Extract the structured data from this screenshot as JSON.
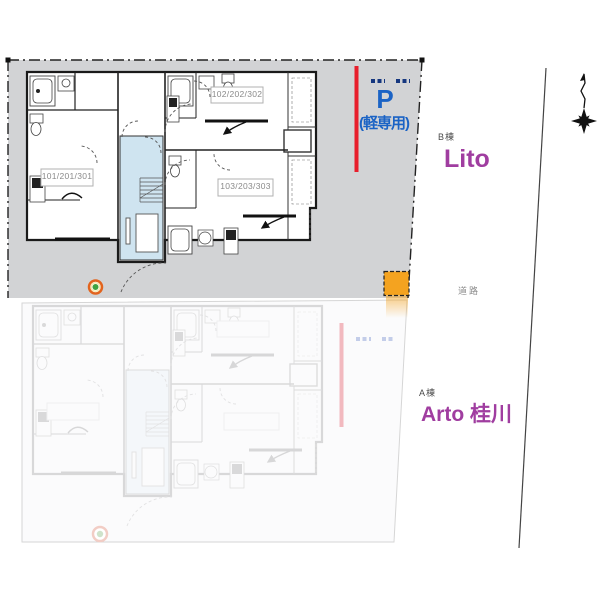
{
  "plan": {
    "buildings": {
      "b": {
        "tag": "B棟",
        "name": "Lito"
      },
      "a": {
        "tag": "A棟",
        "name": "Arto 桂川"
      }
    },
    "parking": {
      "symbol": "P",
      "note": "(軽専用)"
    },
    "road": "道路",
    "units": [
      {
        "label": "101/201/301"
      },
      {
        "label": "102/202/302"
      },
      {
        "label": "103/203/303"
      }
    ],
    "colors": {
      "parcel_gray": "#d2d3d5",
      "accent_red": "#e81e2c",
      "accent_blue": "#1b63c5",
      "brand_purple": "#a03da0",
      "marker_orange": "#f4a320",
      "stair_core_blue": "#cfe4f0"
    }
  }
}
